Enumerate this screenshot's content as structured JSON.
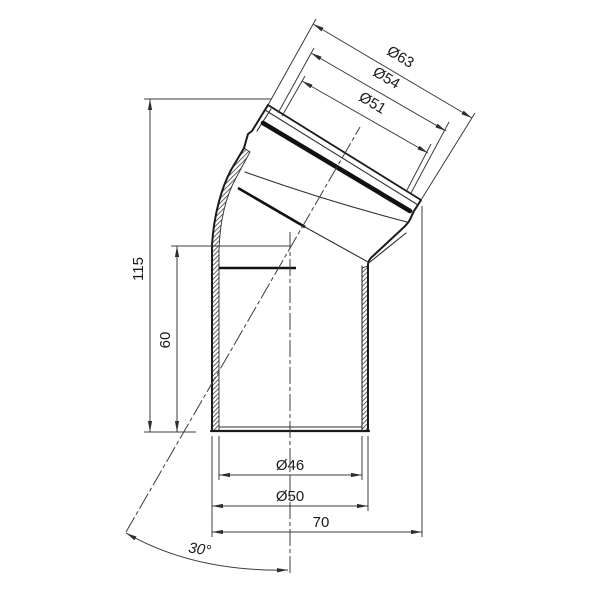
{
  "drawing": {
    "background_color": "#ffffff",
    "line_color": "#1a1a1a",
    "thin_line_color": "#3c3c3c",
    "labels": {
      "socket_outer_dia": "Ø63",
      "socket_mid_dia": "Ø54",
      "socket_inner_dia": "Ø51",
      "total_height": "115",
      "center_height": "60",
      "bore_dia": "Ø46",
      "pipe_outer_dia": "Ø50",
      "horizontal_span": "70",
      "bend_angle": "30°"
    }
  }
}
